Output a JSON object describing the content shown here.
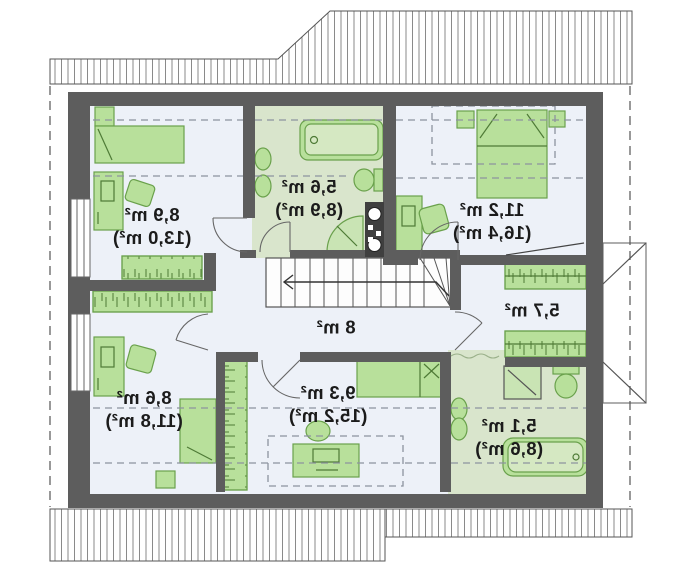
{
  "plan": {
    "kind": "attic-floor-plan",
    "mirrored_text": true,
    "units": "m²",
    "rooms": [
      {
        "id": "room-top-left",
        "area": "8,9 m²",
        "floor_area": "(13,0 m²)"
      },
      {
        "id": "bathroom-top",
        "area": "5,6 m²",
        "floor_area": "(8,9 m²)"
      },
      {
        "id": "bedroom-top-right",
        "area": "11,2 m²",
        "floor_area": "(16,4 m²)"
      },
      {
        "id": "wardrobe-right",
        "area": "5,7 m²",
        "floor_area": ""
      },
      {
        "id": "hall-center",
        "area": "8 m²",
        "floor_area": ""
      },
      {
        "id": "room-bottom-left",
        "area": "8,6 m²",
        "floor_area": "(11,8 m²)"
      },
      {
        "id": "room-bottom-center",
        "area": "9,3 m²",
        "floor_area": "(15,2 m²)"
      },
      {
        "id": "bathroom-bottom-right",
        "area": "5,1 m²",
        "floor_area": "(8,6 m²)"
      }
    ],
    "colors": {
      "wall": "#5d5d5d",
      "room_floor": "#edf1f8",
      "bathroom_floor": "#d9e5cc",
      "furniture_fill": "#b8e09b",
      "furniture_stroke": "#6aa14c",
      "label_text": "#1b1b1b",
      "dashed_line": "#8d939e",
      "eave_hatch": "#8a8a8a"
    }
  }
}
